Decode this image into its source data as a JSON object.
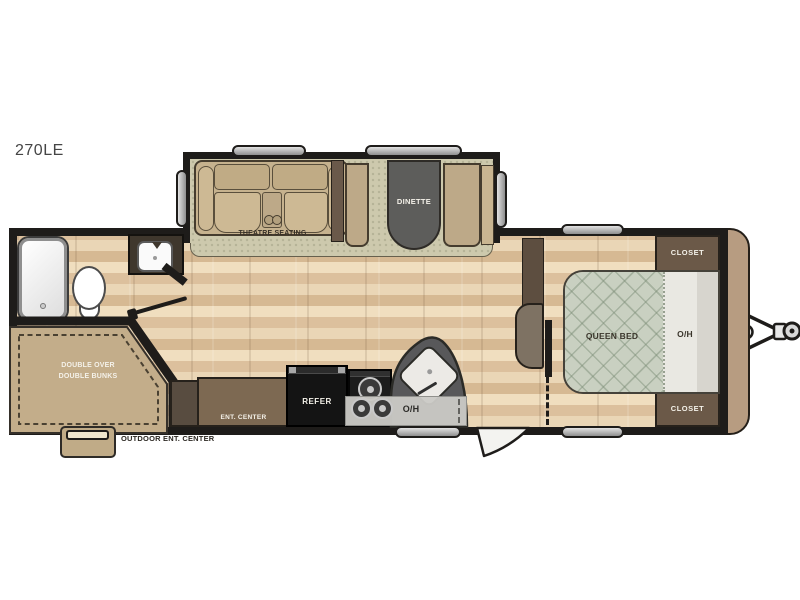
{
  "model_label": "270LE",
  "slideout": {
    "theatre_label": "THEATRE SEATING",
    "dinette_label": "DINETTE"
  },
  "bedroom": {
    "queen_bed_label": "QUEEN BED",
    "overhead_label": "O/H",
    "closet_top_label": "CLOSET",
    "closet_bottom_label": "CLOSET"
  },
  "kitchen": {
    "refrigerator_label": "REFER",
    "overhead_label": "O/H",
    "ent_center_label": "ENT. CENTER"
  },
  "bunkroom": {
    "line1": "DOUBLE OVER",
    "line2": "DOUBLE BUNKS"
  },
  "exterior": {
    "outdoor_ent_center_label": "OUTDOOR ENT. CENTER"
  },
  "colors": {
    "wall": "#1e1c1a",
    "wood_floor": "#e4cdab",
    "carpet": "#cdc9ad",
    "cabinet_dark_brown": "#6b5948",
    "cabinet_mid_brown": "#7d6952",
    "sofa_tan": "#c6b28e",
    "bed_quilt_sage": "#c9d0c1",
    "overhead_gray": "#cbcac6",
    "appliance_black": "#141414",
    "counter_gray": "#58585a",
    "front_cap_tan": "#b79c81"
  }
}
